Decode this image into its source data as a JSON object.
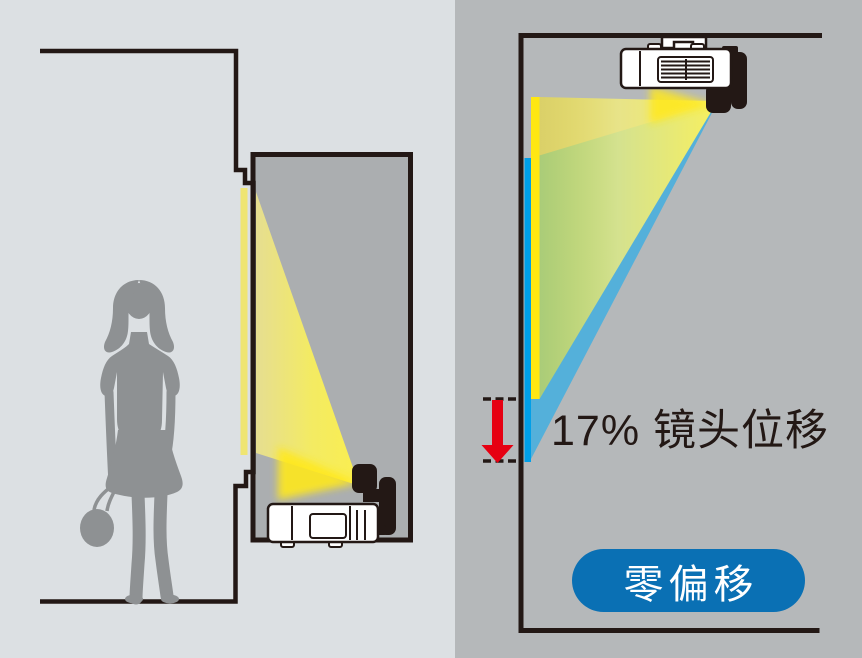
{
  "diagram": {
    "title_visible": false,
    "left_panel": {
      "description": "person beside wall niche with projector mounted low, beam projecting up onto screen",
      "elements": [
        "person-silhouette",
        "wall-niche",
        "floor-projector",
        "projection-beam"
      ]
    },
    "right_panel": {
      "description": "ceiling-mounted projector with shifted image (yellow) vs zero-offset image (blue)",
      "elements": [
        "ceiling-projector",
        "yellow-shifted-beam",
        "blue-zero-offset-beam",
        "shift-arrow"
      ]
    }
  },
  "annotations": {
    "lens_shift_label": "17% 镜头位移",
    "zero_offset_badge": "零偏移"
  },
  "colors": {
    "bg_left": "#dce0e3",
    "bg_right": "#b5b8ba",
    "alcove_gray": "#abaeb0",
    "outline_black": "#231815",
    "projector_white": "#ffffff",
    "beam_yellow_bright": "#ffe712",
    "screen_strip_left": "#efe573",
    "beam_blue": "#54b0da",
    "screen_strip_blue": "#009fe8",
    "lens_glow_yellow": "#ffe81e",
    "arrow_red": "#e60012",
    "pill_blue": "#0a70b4",
    "pill_text": "#ffffff",
    "label_text": "#231815",
    "silhouette_gray": "#8e9193"
  }
}
